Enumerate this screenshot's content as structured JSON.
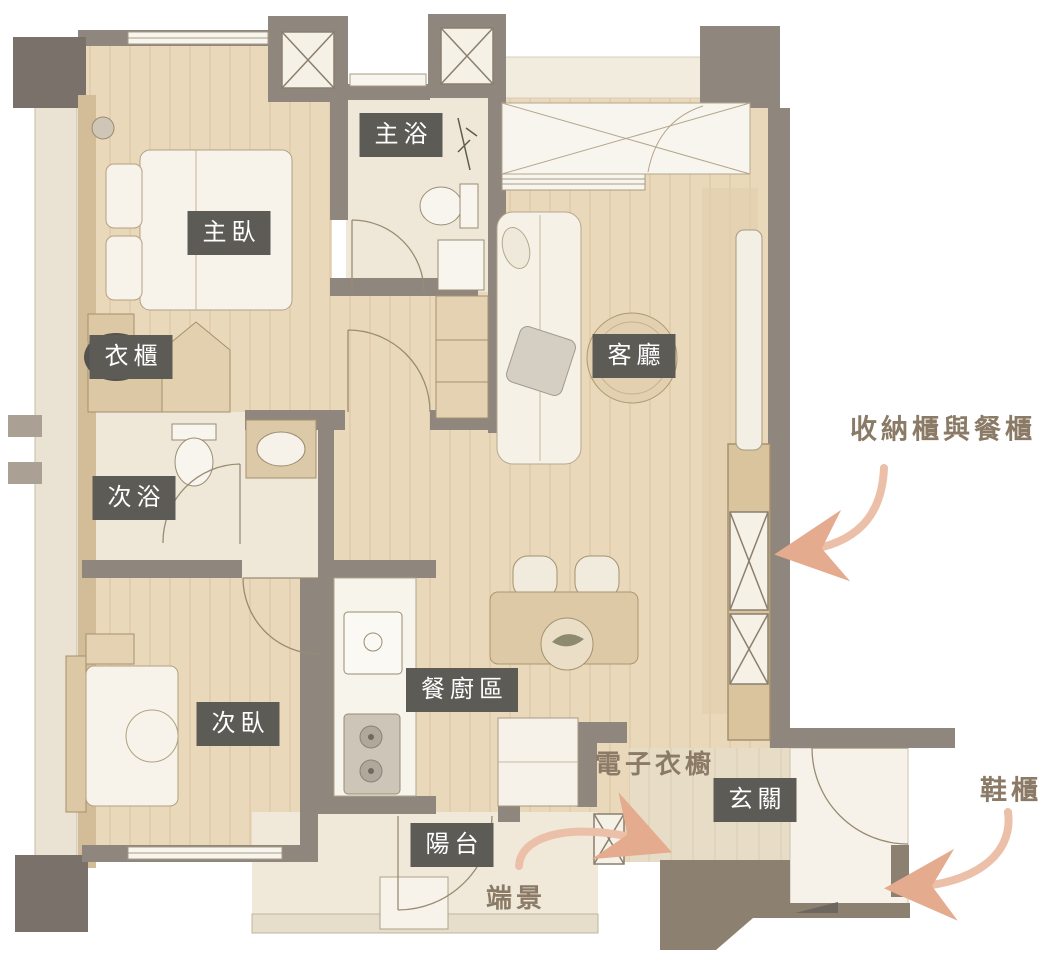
{
  "labels": {
    "master_bath": "主浴",
    "master_bedroom": "主臥",
    "wardrobe": "衣櫃",
    "living_room": "客廳",
    "secondary_bath": "次浴",
    "secondary_bedroom": "次臥",
    "dining_kitchen": "餐廚區",
    "entry": "玄關",
    "balcony": "陽台"
  },
  "annotations": {
    "storage_dining_cabinet": "收納櫃與餐櫃",
    "electronic_wardrobe": "電子衣櫥",
    "end_view": "端景",
    "shoe_cabinet": "鞋櫃"
  },
  "colors": {
    "label_background": "#5d5b56",
    "label_text": "#ffffff",
    "annotation_text": "#8a7a66",
    "arrow": "#ecbfa8",
    "wall": "#8f877d",
    "wall_dark": "#79716a",
    "entry_porch": "#8c8071",
    "wood_floor": "#ead8bb",
    "tile_floor": "#efe8d9"
  }
}
